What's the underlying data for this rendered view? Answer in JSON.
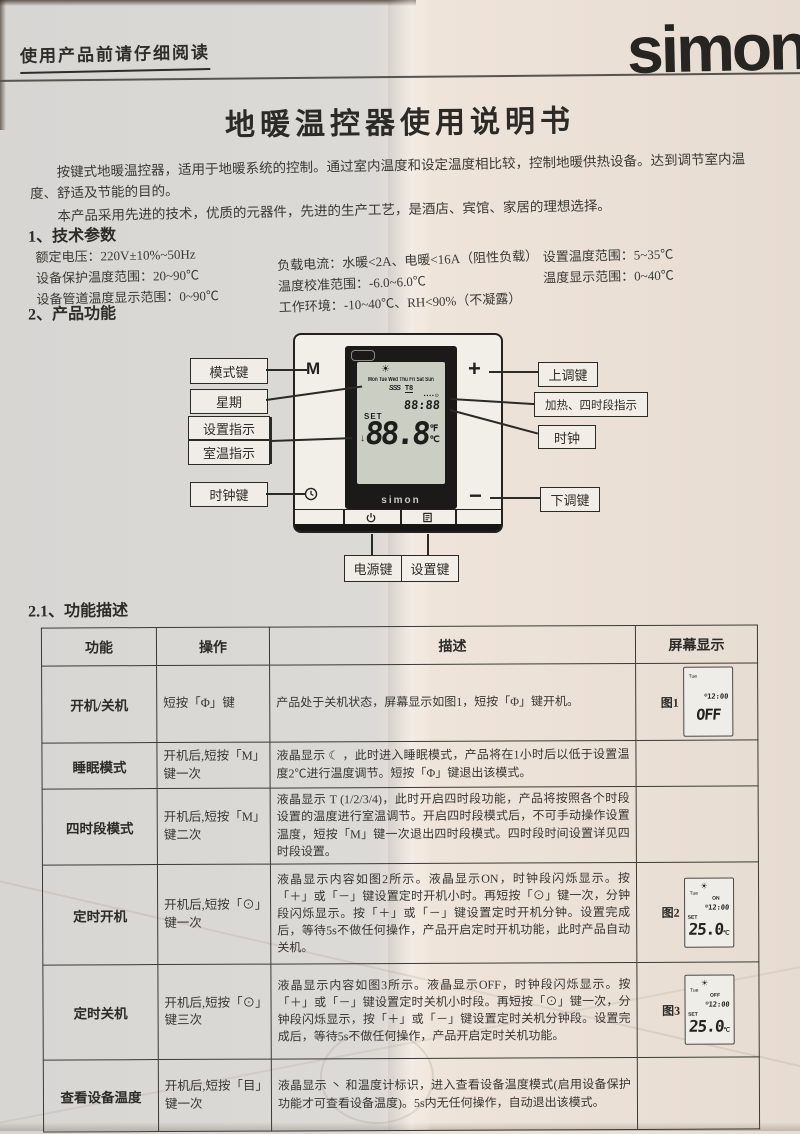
{
  "colors": {
    "brand_text": "#262522",
    "paper_left": "#d8d6d3",
    "paper_right": "#e7dcd2",
    "lcd_bg": "#cbcfc3"
  },
  "header": {
    "read_note": "使用产品前请仔细阅读",
    "brand": "simon"
  },
  "title": "地暖温控器使用说明书",
  "intro": {
    "p1": "按键式地暖温控器，适用于地暖系统的控制。通过室内温度和设定温度相比较，控制地暖供热设备。达到调节室内温度、舒适及节能的目的。",
    "p2": "本产品采用先进的技术，优质的元器件，先进的生产工艺，是酒店、宾馆、家居的理想选择。"
  },
  "tech": {
    "heading": "1、技术参数",
    "col1": [
      "额定电压：220V±10%~50Hz",
      "设备保护温度范围：20~90℃",
      "设备管道温度显示范围：0~90℃"
    ],
    "col2": [
      "负载电流：水暖<2A、电暖<16A（阻性负载）",
      "温度校准范围：-6.0~6.0℃",
      "工作环境：-10~40℃、RH<90%（不凝露）"
    ],
    "col3": [
      "设置温度范围：5~35℃",
      "温度显示范围：0~40℃"
    ]
  },
  "features": {
    "heading": "2、产品功能"
  },
  "diagram": {
    "labels": {
      "mode_key": "模式键",
      "week": "星期",
      "set_indicator": "设置指示",
      "room_indicator": "室温指示",
      "clock_key": "时钟键",
      "up_key": "上调键",
      "heat_period_indicator": "加热、四时段指示",
      "clock": "时钟",
      "down_key": "下调键",
      "power_key": "电源键",
      "set_key": "设置键"
    },
    "panel": {
      "mode_symbol": "M",
      "plus_symbol": "+",
      "minus_symbol": "−",
      "brand": "simon",
      "lcd": {
        "sun": "☀",
        "week_row": "Mon Tue Wed Thu Fri Sat Sun",
        "heat_waves": "SSS",
        "period": "T8",
        "period_icons": "▪▪▪▪⊙",
        "time": "88:88",
        "set_label": "SET",
        "arrow": "↓",
        "temp": "88.8",
        "unit_f": "℉",
        "unit_c": "℃"
      }
    }
  },
  "func_table": {
    "heading": "2.1、功能描述",
    "headers": [
      "功能",
      "操作",
      "描述",
      "屏幕显示"
    ],
    "rows": [
      {
        "func": "开机/关机",
        "op": "短按「Φ」键",
        "desc": "产品处于关机状态，屏幕显示如图1，短按「Φ」键开机。",
        "fig": {
          "label": "图1",
          "day": "Tue",
          "clock_icon": "⊙",
          "time": "12:00",
          "big": "OFF"
        }
      },
      {
        "func": "睡眠模式",
        "op": "开机后,短按「M」键一次",
        "desc": "液晶显示 ☾ ，此时进入睡眠模式，产品将在1小时后以低于设置温度2℃进行温度调节。短按「Φ」键退出该模式。"
      },
      {
        "func": "四时段模式",
        "op": "开机后,短按「M」键二次",
        "desc": "液晶显示 T (1/2/3/4)，此时开启四时段功能，产品将按照各个时段设置的温度进行室温调节。开启四时段模式后，不可手动操作设置温度，短按「M」键一次退出四时段模式。四时段时间设置详见四时段设置。"
      },
      {
        "func": "定时开机",
        "op": "开机后,短按「⊙」键一次",
        "desc": "液晶显示内容如图2所示。液晶显示ON，时钟段闪烁显示。按「＋」或「－」键设置定时开机小时。再短按「⊙」键一次，分钟段闪烁显示。按「＋」或「－」键设置定时开机分钟。设置完成后，等待5s不做任何操作，产品开启定时开机功能，此时产品自动关机。",
        "fig": {
          "label": "图2",
          "sun": "☀",
          "day": "Tue",
          "state": "ON",
          "clock_icon": "⊙",
          "time": "12:00",
          "set": "SET",
          "big": "25.0",
          "unit": "℃"
        }
      },
      {
        "func": "定时关机",
        "op": "开机后,短按「⊙」键三次",
        "desc": "液晶显示内容如图3所示。液晶显示OFF，时钟段闪烁显示。按「＋」或「－」键设置定时关机小时段。再短按「⊙」键一次，分钟段闪烁显示，按「＋」或「－」键设置定时关机分钟段。设置完成后，等待5s不做任何操作，产品开启定时关机功能。",
        "fig": {
          "label": "图3",
          "sun": "☀",
          "day": "Tue",
          "state": "OFF",
          "clock_icon": "⊙",
          "time": "12:00",
          "set": "SET",
          "big": "25.0",
          "unit": "℃"
        }
      },
      {
        "func": "查看设备温度",
        "op": "开机后,短按「目」键一次",
        "desc": "液晶显示 丶 和温度计标识，进入查看设备温度模式(启用设备保护功能才可查看设备温度)。5s内无任何操作，自动退出该模式。"
      }
    ]
  }
}
